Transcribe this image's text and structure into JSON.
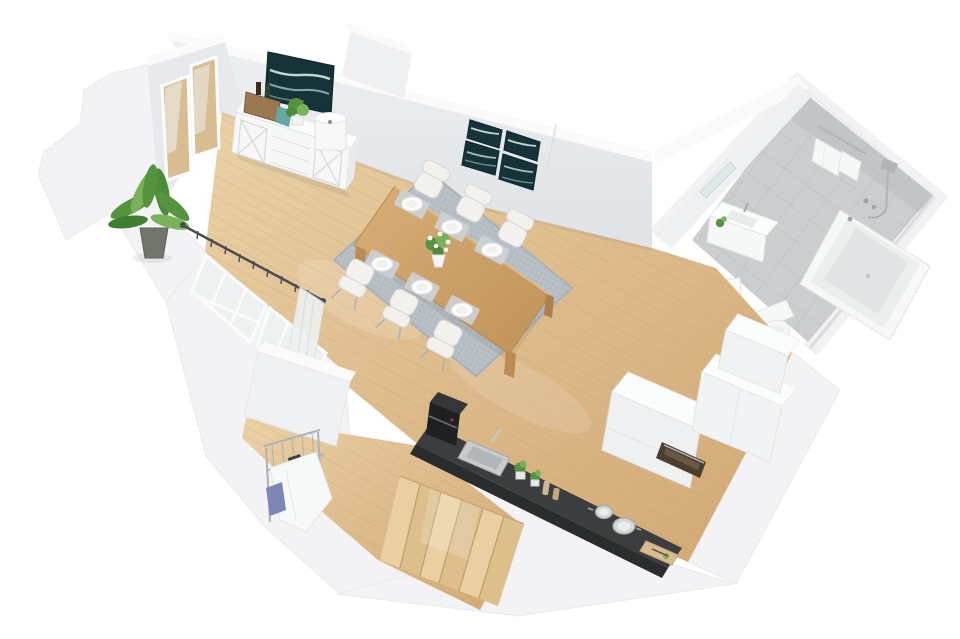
{
  "scene": {
    "type": "3d-floor-plan-render",
    "view": "isometric-top-down",
    "background": "plain-white",
    "rooms": [
      {
        "name": "living-dining-room",
        "floor": "light-oak-plank",
        "items": [
          "glass-balcony-door",
          "potted-palm",
          "white-sideboard",
          "storage-basket",
          "wine-bottles",
          "teal-cloth",
          "potted-plant",
          "drum-table-lamp",
          "wall-art-single",
          "wall-art-four-panel",
          "dining-table",
          "six-white-chairs",
          "gray-area-rug",
          "six-place-settings",
          "flower-centerpiece",
          "paneled-low-windows",
          "curtain-rod",
          "sheer-curtain"
        ]
      },
      {
        "name": "kitchen",
        "floor": "light-oak-plank",
        "items": [
          "dark-countertop",
          "coffee-machine",
          "inset-sink",
          "herb-pots",
          "spice-grinders",
          "two-steel-pots",
          "cutting-board",
          "built-in-oven",
          "tall-white-cabinets",
          "white-drawer-units"
        ]
      },
      {
        "name": "bathroom",
        "floor": "gray-tile",
        "items": [
          "bathtub",
          "shower-fixture",
          "towel-rail-with-towels",
          "washbasin-cabinet",
          "mirror",
          "toilet",
          "white-panel-door",
          "small-plant"
        ]
      },
      {
        "name": "hallway",
        "floor": "light-oak-plank",
        "items": [
          "wooden-staircase",
          "laundry-drying-rack",
          "hanging-laundry",
          "partition-wall"
        ]
      }
    ]
  },
  "palette": {
    "background": "#ffffff",
    "wall_top": "#fafafb",
    "wall_face": "#e8eaed",
    "wall_outer": "#f3f3f5",
    "wall_edge": "#e9eaec",
    "wood_hi": "#e9d0a3",
    "wood_lo": "#d2ab77",
    "wood_line": "#b98f5e",
    "tile_floor": "#cbcdcf",
    "tile_wall": "#c2c5c8",
    "tile_line": "#b7babd",
    "rug": "#b6bdc4",
    "rug_edge": "#a8b0b8",
    "white_obj": "#f6f7f7",
    "white_obj_edge": "#e2e4e5",
    "counter_top": "#3b3d3e",
    "counter_front": "#2a2c2d",
    "appliance": "#1f2021",
    "art": "#16333a",
    "art_streak": "#d7e8e2",
    "green": "#55943f",
    "green_light": "#79b25a",
    "pot": "#71756c",
    "metal": "#aeb2b4",
    "rod": "#4b4b50",
    "glass": "#dfe6e8",
    "oven": "#4a3e31",
    "blue_cloth": "#7d87b5",
    "teal_cloth": "#63a8a2",
    "basket": "#9b7950",
    "table_hi": "#d2a770",
    "table_lo": "#c2955c",
    "shadow": "#1a1a1a"
  }
}
